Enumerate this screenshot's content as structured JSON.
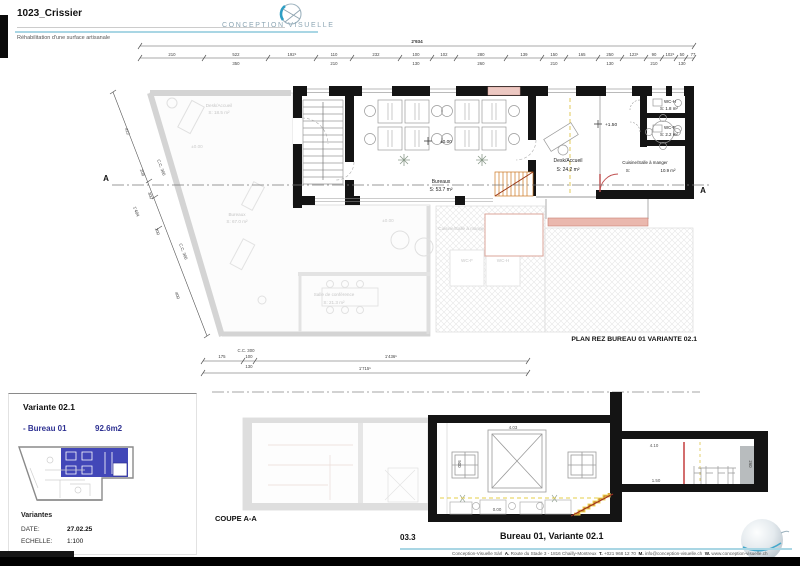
{
  "header": {
    "project_code": "1023_Crissier",
    "subtitle": "Réhabilitation d'une surface artisanale",
    "logo_text": "CONCEPTION   VISUELLE"
  },
  "plan": {
    "title": "PLAN REZ BUREAU 01 VARIANTE 02.1",
    "dim_total": "2'934",
    "dims_top": [
      "210",
      "522",
      "350",
      "192⁵",
      "110",
      "210",
      "232",
      "100",
      "130",
      "102",
      "280",
      "260",
      "139",
      "150",
      "210",
      "165",
      "250",
      "130",
      "123⁵",
      "90",
      "210",
      "102⁵",
      "50",
      "130",
      "77"
    ],
    "dims_left": [
      "412",
      "208",
      "300",
      "1'484",
      "200",
      "400"
    ],
    "cc_label": "C.C. 300",
    "dims_bottom": [
      "175",
      "100",
      "130",
      "1'436⁵",
      "1'715⁵"
    ],
    "marker": "A",
    "levels": {
      "ground": "±0.00",
      "upper": "+1.50"
    },
    "rooms": {
      "bureaux": {
        "name": "Bureaux",
        "area": "S: 53.7 m²"
      },
      "desk": {
        "name": "Desk/Accueil",
        "area": "S:    24.2 m²"
      },
      "cuisine": {
        "name": "Cuisine/Salle à manger",
        "s": "S:",
        "area": "10.9 m²"
      },
      "wch": {
        "name": "WC-H",
        "area": "S: 1.8 m²"
      },
      "wcf": {
        "name": "WC-F",
        "area": "S: 2.2 m²"
      }
    },
    "faded": {
      "desk": {
        "name": "Desk/Accueil",
        "area": "S:  18.5 m²"
      },
      "bureaux": {
        "name": "Bureaux",
        "area": "S: 67.0 m²"
      },
      "salle": {
        "name": "Salle de conférence",
        "area": "S:   21.3 m²"
      },
      "cuisine": {
        "name": "Cuisine/Salle à manger"
      },
      "wcf": "WC-F",
      "wch": "WC-H",
      "level": "±0.00"
    }
  },
  "section": {
    "label": "COUPE A-A",
    "lvl_hall": "4.03",
    "lvl_right": "4.10",
    "lvl_mezz": "1.50",
    "lvl_ground": "0.00",
    "dim_left": "500",
    "dim_right": "260"
  },
  "variant_panel": {
    "title": "Variante 02.1",
    "item_label": "- Bureau 01",
    "item_area": "92.6m2",
    "list_title": "Variantes",
    "date_label": "DATE:",
    "date_value": "27.02.25",
    "scale_label": "ECHELLE:",
    "scale_value": "1:100"
  },
  "footer": {
    "sheet_number": "03.3",
    "sheet_title": "Bureau 01, Variante 02.1",
    "contact": {
      "c0": "Conception-Visuelle Sàrl",
      "l1": "A.",
      "c1": "Route du Stade 3 - 1816 Chailly-Montreux",
      "l2": "T.",
      "c2": "+021 968 12 70",
      "l3": "M.",
      "c3": "info@conception-visuelle.ch",
      "l4": "W.",
      "c4": "www.conception-visuelle.ch"
    }
  }
}
